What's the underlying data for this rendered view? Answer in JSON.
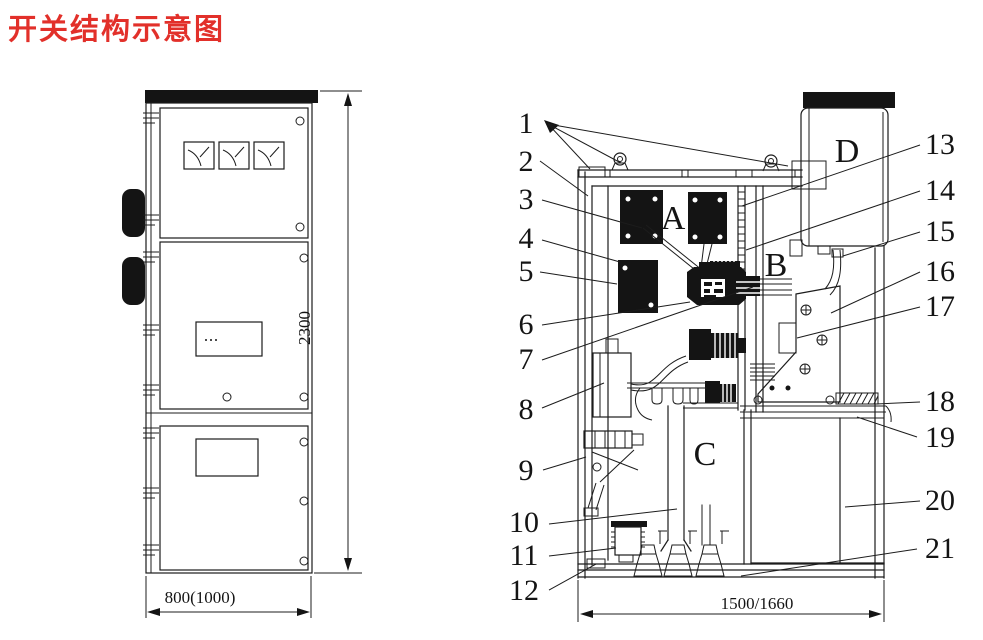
{
  "title": "开关结构示意图",
  "colors": {
    "title_red": "#e2302a",
    "line": "#1c1c1c"
  },
  "front_view": {
    "description": "cabinet front view",
    "height_dim": "2300",
    "width_dim": "800(1000)"
  },
  "side_view": {
    "description": "cabinet side section view",
    "width_dim": "1500/1660",
    "compartment_labels": {
      "a": "A",
      "b": "B",
      "c": "C",
      "d": "D"
    }
  },
  "callouts": {
    "left": [
      "1",
      "2",
      "3",
      "4",
      "5",
      "6",
      "7",
      "8",
      "9",
      "10",
      "11",
      "12"
    ],
    "right": [
      "13",
      "14",
      "15",
      "16",
      "17",
      "18",
      "19",
      "20",
      "21"
    ]
  }
}
